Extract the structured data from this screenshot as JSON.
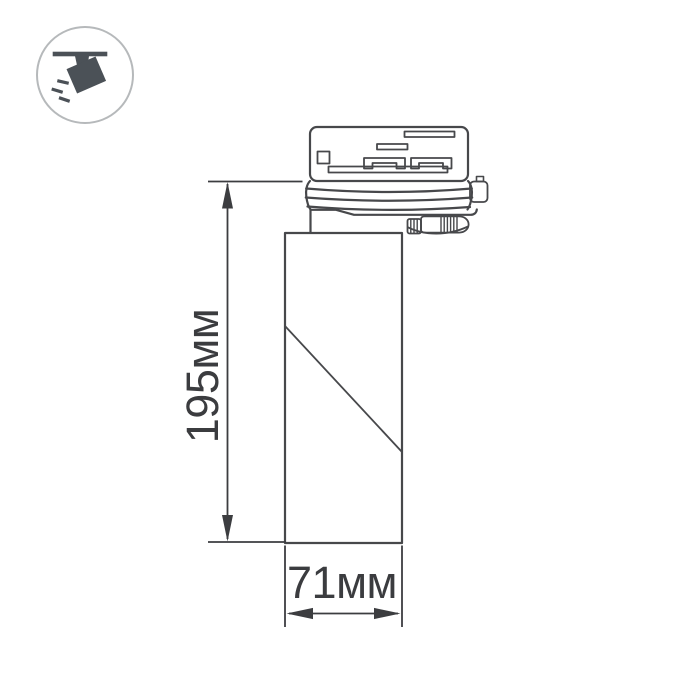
{
  "badge": {
    "icon": "track-spotlight-icon",
    "circle_color": "#b6b9bb",
    "glyph_color": "#4b5157"
  },
  "drawing": {
    "line_color": "#47484b",
    "parts": [
      "track-adapter",
      "locking-knob",
      "lamp-body"
    ]
  },
  "dimensions": {
    "color": "#3c3d40",
    "height": {
      "label": "195мм",
      "value": 195,
      "unit": "мм"
    },
    "width": {
      "label": "71мм",
      "value": 71,
      "unit": "мм"
    }
  }
}
